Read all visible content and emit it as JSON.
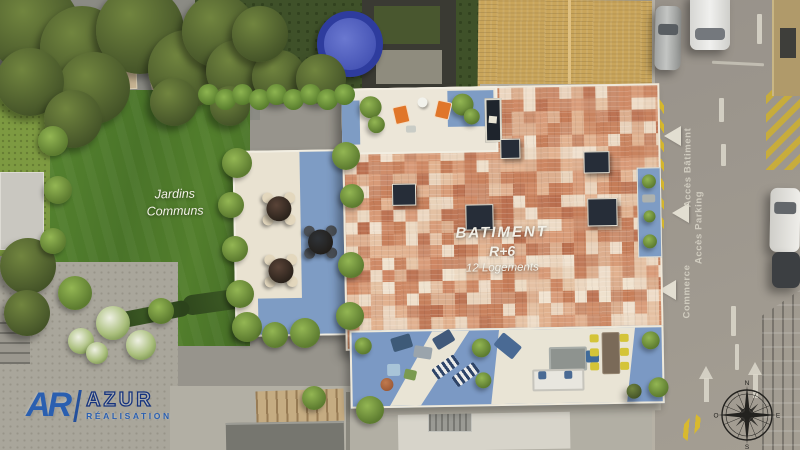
{
  "project": {
    "building_label": "BATIMENT",
    "building_level": "R+6",
    "building_units": "12 Logements"
  },
  "garden": {
    "label_line1": "Jardins",
    "label_line2": "Communs"
  },
  "road": {
    "access_building": "Accès Bâtiment",
    "access_parking": "Accès Parking",
    "commerce": "Commerce"
  },
  "logo": {
    "monogram": "AR",
    "company": "AZUR",
    "tagline": "RÉALISATION"
  },
  "compass": {
    "north": "N",
    "east": "E",
    "south": "S",
    "west": "O"
  },
  "colors": {
    "roof_palette": [
      "#ecd9c3",
      "#dcae8e",
      "#cd8763",
      "#ba6f4f",
      "#e6c4a6",
      "#d89a77",
      "#c57c58",
      "#f0e2cf",
      "#c98a6a",
      "#e2b290"
    ],
    "lawn_green": "#4d7a2d",
    "terrace_blue": "#7b99c4",
    "terrace_cream": "#e9e2d1",
    "road_gray": "#9c968c",
    "accent_orange": "#e0762a",
    "marking_yellow": "#d8b92e",
    "brand_blue": "#2a5fb0"
  }
}
